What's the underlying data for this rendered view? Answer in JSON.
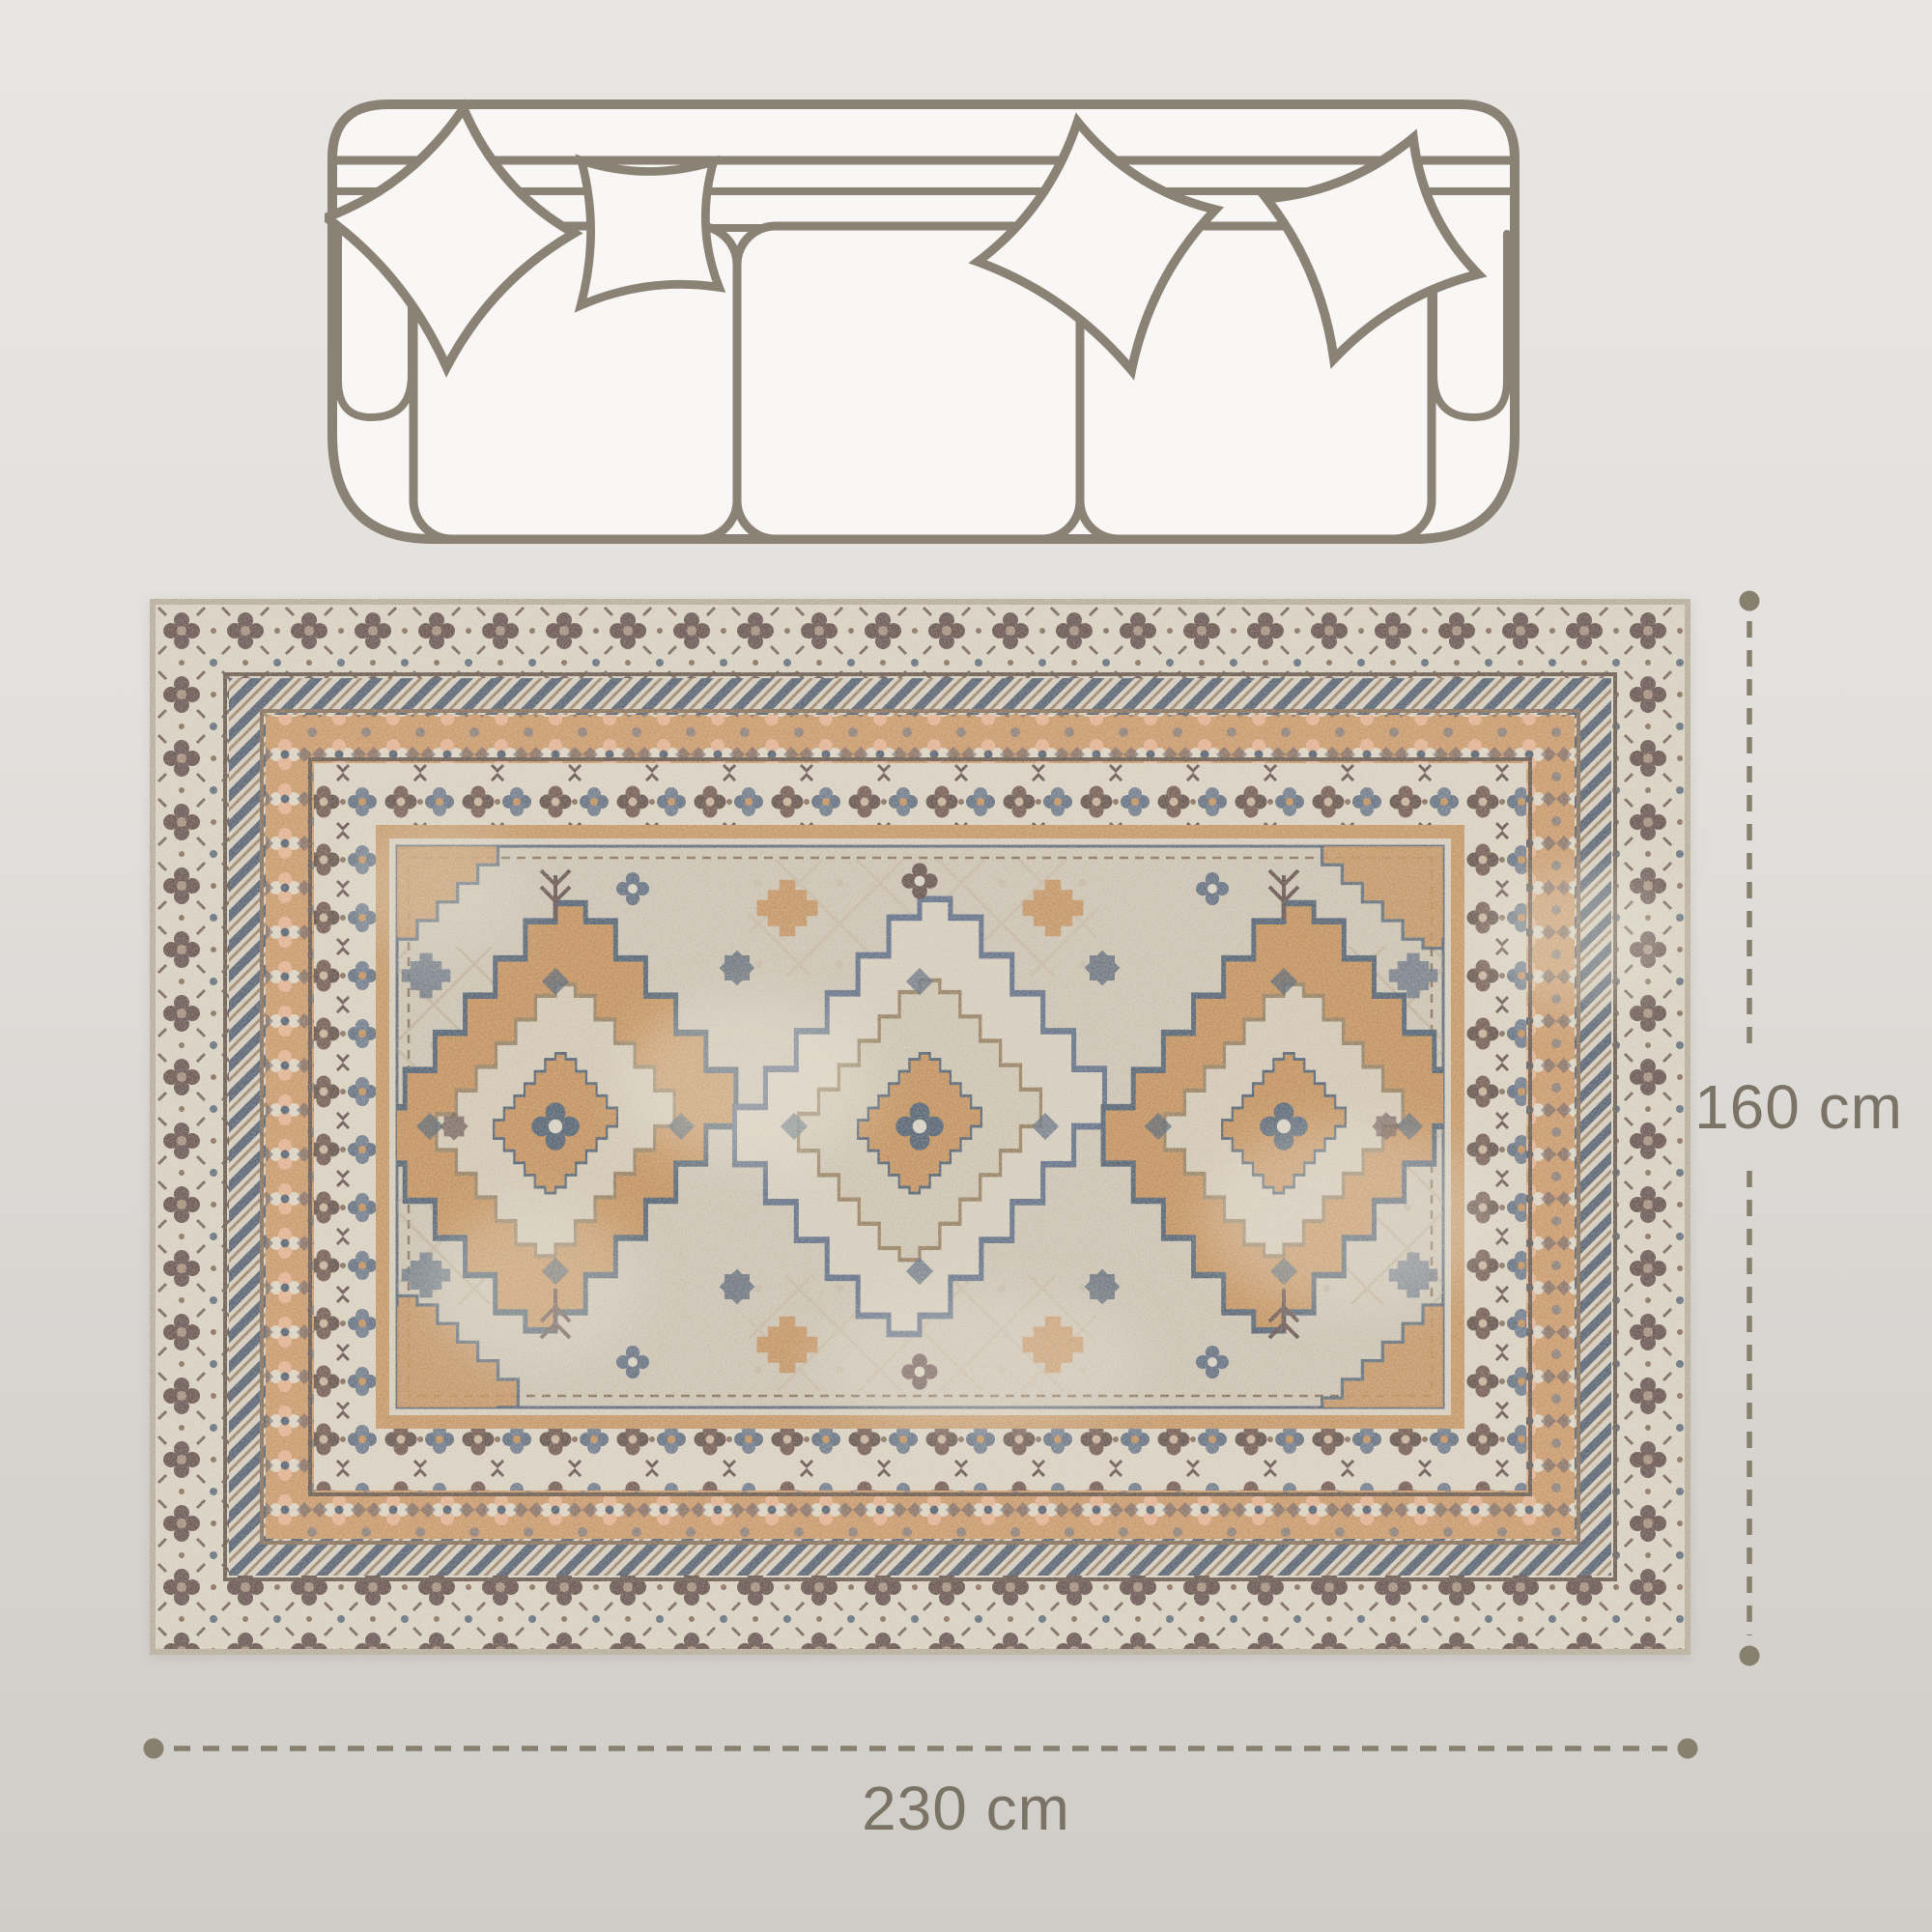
{
  "diagram": {
    "type": "product-dimension-diagram",
    "product": "vintage distressed oriental area rug with three diamond medallions",
    "scene": {
      "sofa_icon": "sofa-top-view-outline",
      "sofa_pillows": 4,
      "rug_image": "rug-top-view-photo",
      "rug_medallions": 3
    },
    "dimensions": {
      "height": {
        "label": "160 cm",
        "orientation": "vertical"
      },
      "width": {
        "label": "230 cm",
        "orientation": "horizontal"
      }
    },
    "colors": {
      "background_top": "#e8e6e2",
      "background_bottom": "#d0cdc8",
      "dimension_line": "#87806e",
      "dimension_text": "#7a7366",
      "sofa_outline": "#8a8274",
      "sofa_fill": "#f8f7f5",
      "rug_edge": "#b9af9e",
      "rug_border_cream": "#d8d1c2",
      "rug_field": "#ccc3b3",
      "rug_tan": "#c49463",
      "rug_orange_band": "#ca9c70",
      "rug_blue_gray": "#5d6a78",
      "rug_dark_brown": "#6d5a55"
    }
  }
}
